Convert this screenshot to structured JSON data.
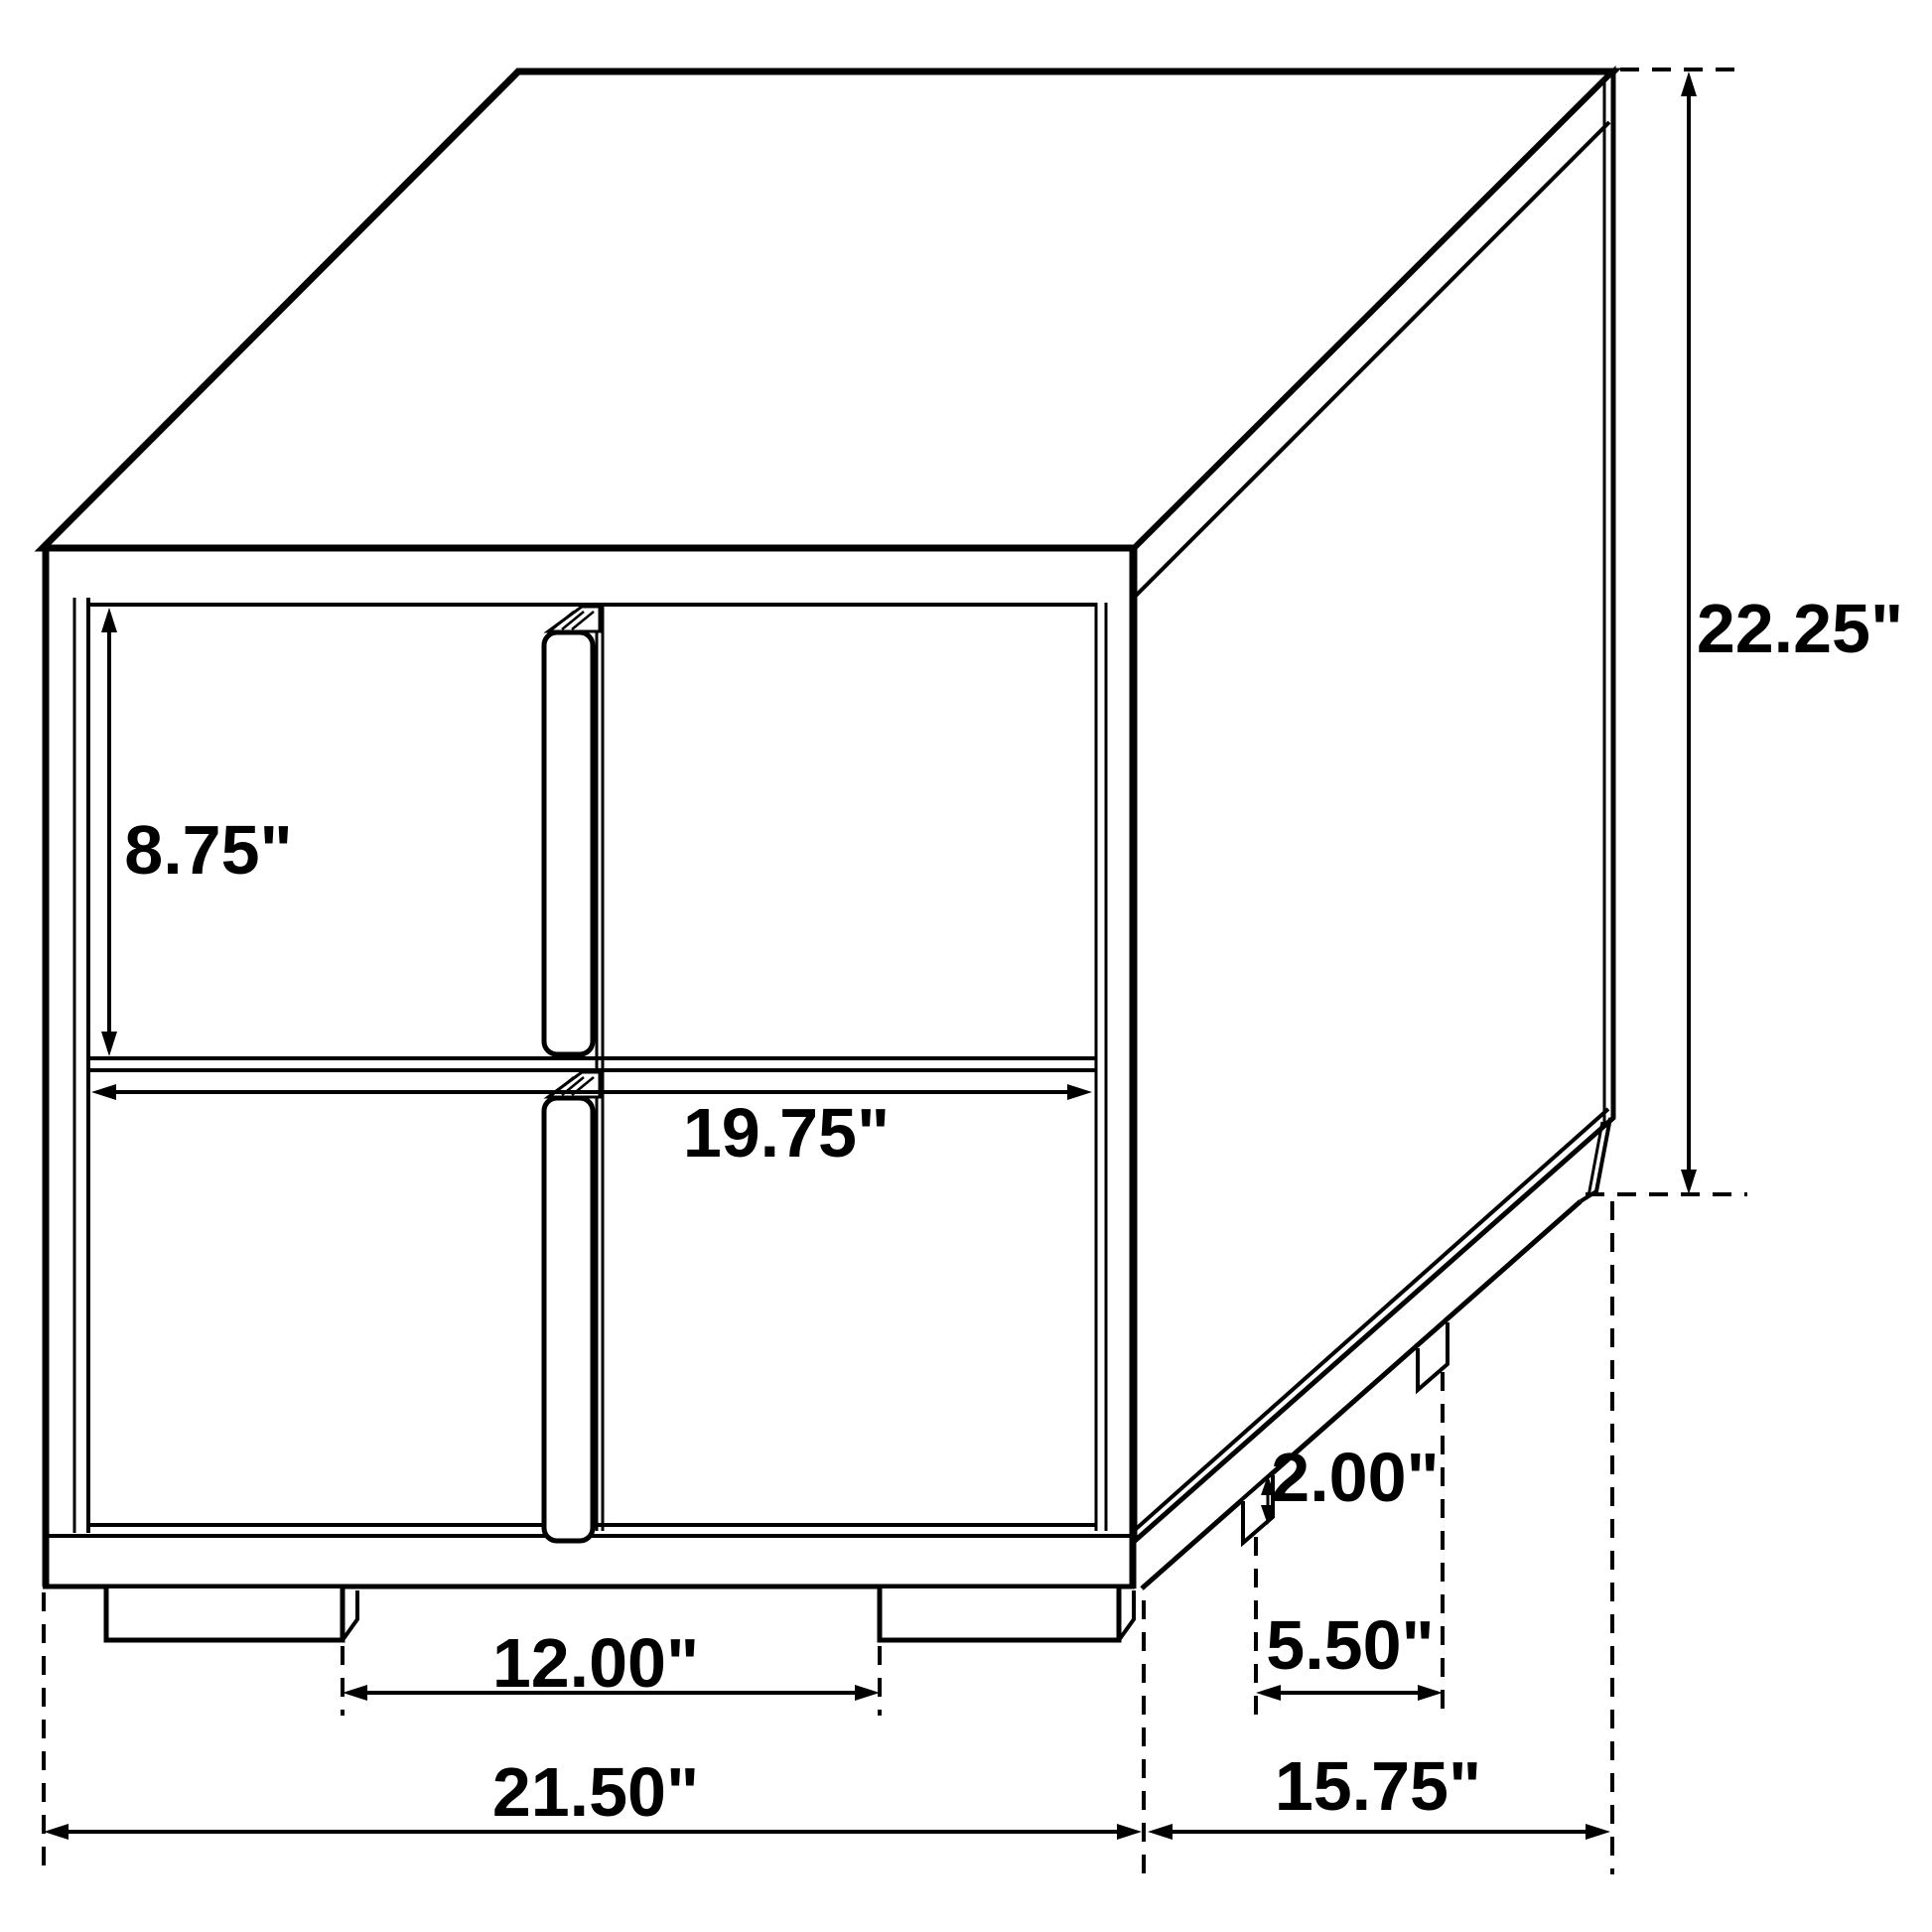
{
  "diagram": {
    "kind": "furniture-dimension-drawing",
    "subject": "two-drawer nightstand isometric line drawing",
    "units": "inches",
    "line_color": "#000000",
    "background_color": "#ffffff",
    "dims": {
      "drawer_front_height": {
        "label": "8.75\""
      },
      "opening_width": {
        "label": "19.75\""
      },
      "overall_height": {
        "label": "22.25\""
      },
      "foot_height": {
        "label": "2.00\""
      },
      "side_feet_gap": {
        "label": "5.50\""
      },
      "front_feet_gap": {
        "label": "12.00\""
      },
      "overall_width": {
        "label": "21.50\""
      },
      "overall_depth": {
        "label": "15.75\""
      }
    }
  }
}
